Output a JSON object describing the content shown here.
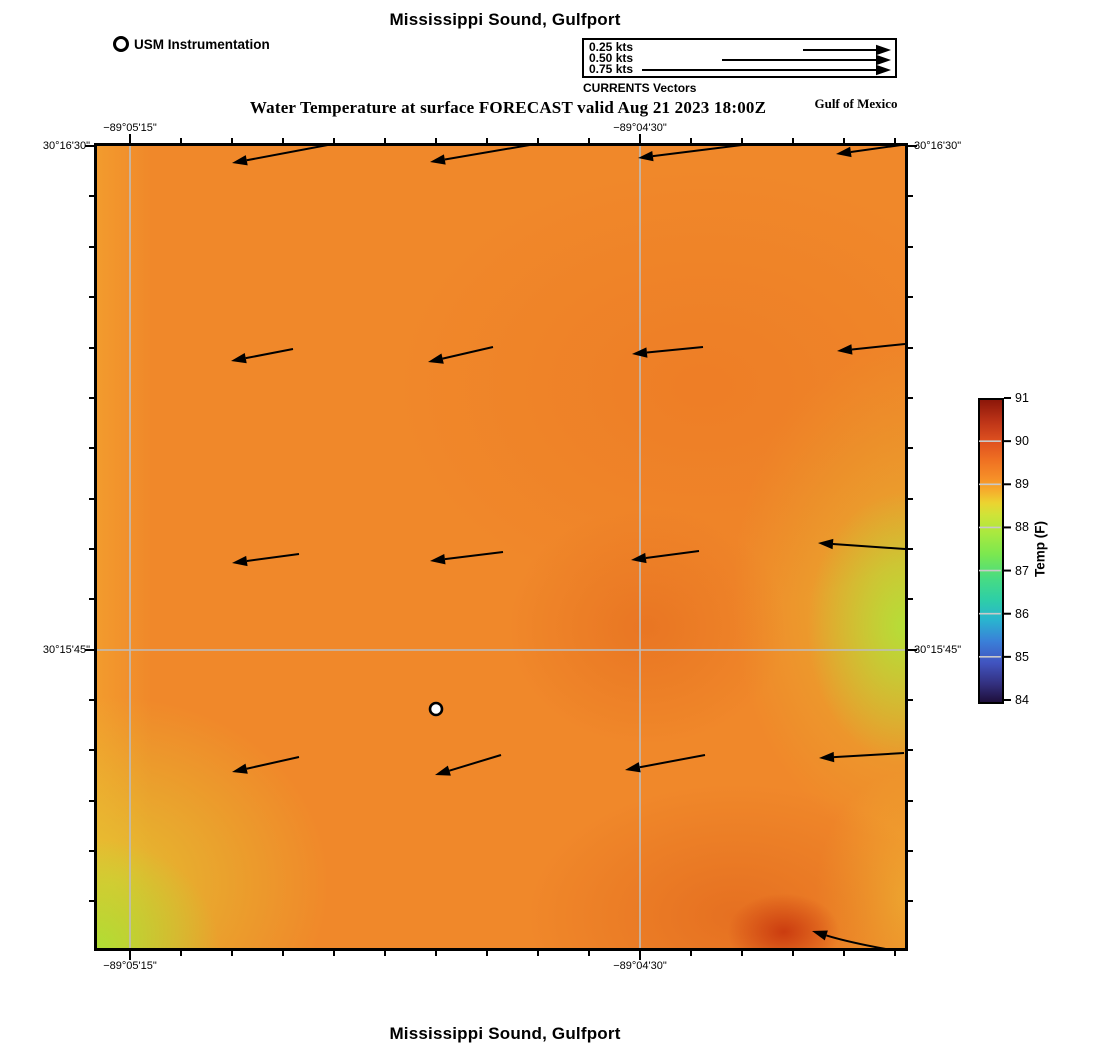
{
  "header": {
    "title": "Mississippi Sound, Gulfport",
    "subtitle": "Water Temperature at surface FORECAST valid Aug 21 2023 18:00Z",
    "region_label": "Gulf of Mexico",
    "instrument_legend_label": "USM Instrumentation",
    "vector_legend": {
      "caption": "CURRENTS Vectors",
      "entries": [
        {
          "label": "0.25 kts",
          "arrow": [
            803,
            50,
            891,
            50
          ]
        },
        {
          "label": "0.50 kts",
          "arrow": [
            722,
            60,
            891,
            60
          ]
        },
        {
          "label": "0.75 kts",
          "arrow": [
            642,
            70,
            891,
            70
          ]
        }
      ]
    }
  },
  "footer": {
    "title": "Mississippi Sound, Gulfport"
  },
  "map": {
    "geometry": {
      "left": 97,
      "top": 146,
      "width": 808,
      "height": 802
    },
    "x_tick_labels": [
      {
        "label": "−89°05'15\"",
        "x": 130
      },
      {
        "label": "−89°04'30\"",
        "x": 640
      }
    ],
    "y_tick_labels": [
      {
        "label": "30°16'30\"",
        "y": 146
      },
      {
        "label": "30°15'45\"",
        "y": 650
      }
    ],
    "x_minor_ticks": [
      130,
      181,
      232,
      283,
      334,
      385,
      436,
      487,
      538,
      589,
      640,
      691,
      742,
      793,
      844,
      895
    ],
    "y_minor_ticks": [
      146,
      196,
      247,
      297,
      348,
      398,
      448,
      499,
      549,
      599,
      650,
      700,
      750,
      801,
      851,
      901
    ],
    "x_major_ticks": [
      130,
      640
    ],
    "y_major_ticks": [
      146,
      650
    ],
    "gridlines": {
      "vertical_x": [
        130,
        640
      ],
      "horizontal_y": [
        650
      ],
      "color": "#bdbdbd"
    },
    "surface_colors": {
      "base_orange": "#f0882a",
      "cool_green_patches": "#b2e138",
      "warm_red_spot": "#c6320c",
      "deep_orange_patch": "#e05f1a"
    }
  },
  "colorbar": {
    "label": "Temp (F)",
    "min": 84,
    "max": 91,
    "ticks": [
      84,
      85,
      86,
      87,
      88,
      89,
      90,
      91
    ],
    "geometry": {
      "left": 978,
      "top": 398,
      "width": 22,
      "height": 302
    }
  },
  "chart_data": {
    "type": "heatmap",
    "title": "Mississippi Sound, Gulfport",
    "subtitle": "Water Temperature at surface FORECAST valid Aug 21 2023 18:00Z",
    "region": "Gulf of Mexico",
    "x_axis": {
      "name": "Longitude",
      "tick_labels": [
        "−89°05'15\"",
        "−89°04'30\""
      ]
    },
    "y_axis": {
      "name": "Latitude",
      "tick_labels": [
        "30°16'30\"",
        "30°15'45\""
      ]
    },
    "color_scale": {
      "label": "Temp (F)",
      "range": [
        84,
        91
      ],
      "tick_values": [
        84,
        85,
        86,
        87,
        88,
        89,
        90,
        91
      ]
    },
    "field_description": [
      "Surface water temperature mostly 89-90 F (orange) across the domain",
      "Cooler patch ~88 F (yellow-green) in southwest corner",
      "Cooler band ~88 F (yellow-green) along east edge near 30°15'45\"",
      "Warmer spot ~90.5 F (dark red) near southeast corner",
      "Slightly warmer ~89.5-90 F areas in east-central region"
    ],
    "current_vectors": {
      "units": "kts",
      "legend_speeds": [
        0.25,
        0.5,
        0.75
      ],
      "direction_summary": "All vectors point approximately west to west-southwest, speeds ~0.2-0.3 kts",
      "arrows_px_tail_to_tip": [
        [
          365,
          138,
          232,
          163
        ],
        [
          565,
          139,
          430,
          162
        ],
        [
          758,
          143,
          638,
          158
        ],
        [
          952,
          138,
          836,
          154
        ],
        [
          293,
          349,
          231,
          361
        ],
        [
          493,
          347,
          428,
          362
        ],
        [
          703,
          347,
          632,
          354
        ],
        [
          905,
          344,
          837,
          351
        ],
        [
          299,
          554,
          232,
          563
        ],
        [
          503,
          552,
          430,
          561
        ],
        [
          699,
          551,
          631,
          560
        ],
        [
          905,
          549,
          818,
          543
        ],
        [
          299,
          757,
          232,
          772
        ],
        [
          501,
          755,
          435,
          775
        ],
        [
          705,
          755,
          625,
          770
        ],
        [
          904,
          753,
          819,
          758
        ]
      ],
      "extra_arrow_px": {
        "tail": [
          897,
          951
        ],
        "ctrl": [
          851,
          943
        ],
        "tip": [
          812,
          931
        ]
      }
    },
    "instrument_stations": [
      {
        "name": "USM Instrumentation",
        "marker": "white-circle",
        "x_px": 436,
        "y_px": 709
      }
    ]
  }
}
